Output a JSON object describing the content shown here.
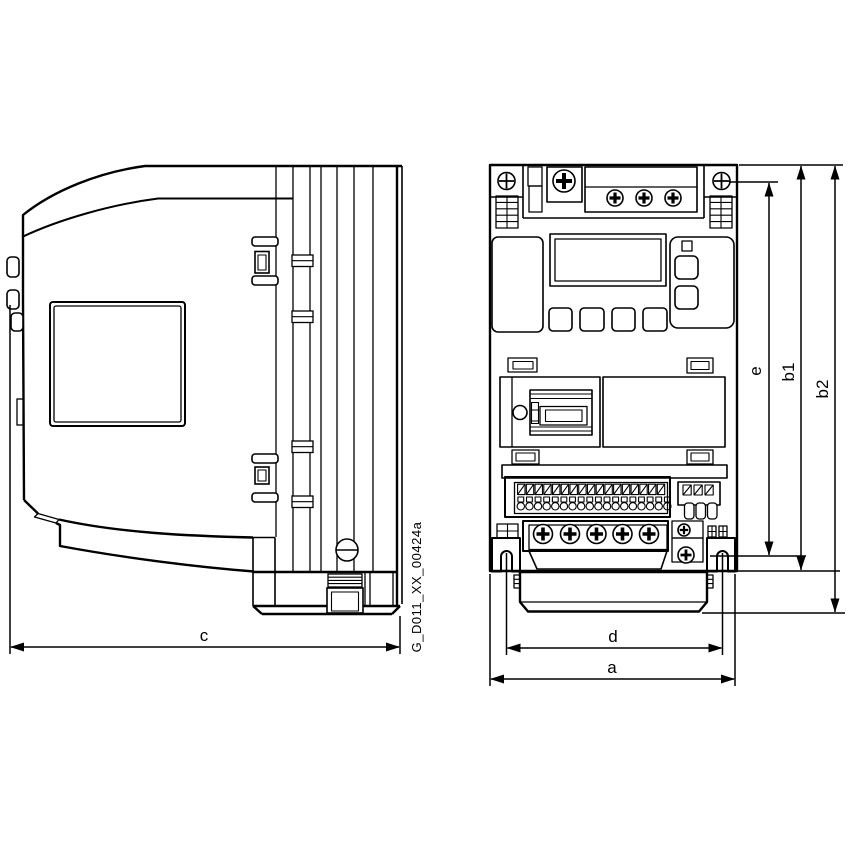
{
  "figure": {
    "id_label": "G_D011_XX_00424a",
    "colors": {
      "line": "#000000",
      "background": "#ffffff"
    },
    "dimensions": {
      "depth": "c",
      "overall_width": "a",
      "mounting_width": "d",
      "mounting_height": "e",
      "body_height": "b1",
      "overall_height": "b2"
    }
  }
}
